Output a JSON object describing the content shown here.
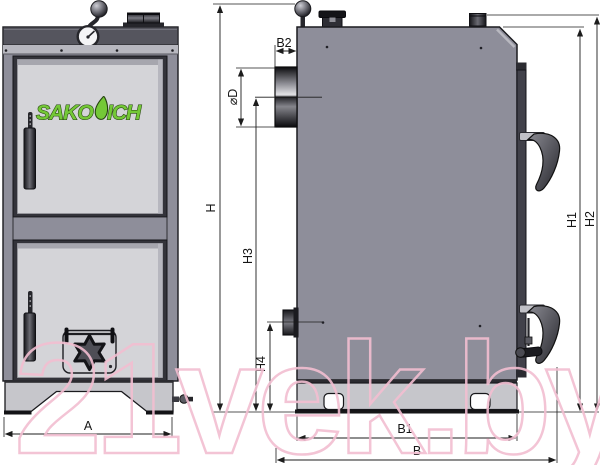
{
  "brand": {
    "name": "SAKOVICH",
    "name_left": "SAKO",
    "name_right": "ICH"
  },
  "watermark": {
    "text": "21vek.by",
    "color": "#f2bed0"
  },
  "dimension_labels": {
    "A": "A",
    "B": "B",
    "B1": "B1",
    "B2": "B2",
    "H": "H",
    "H1": "H1",
    "H2": "H2",
    "H3": "H3",
    "H4": "H4",
    "D": "⌀D"
  },
  "palette": {
    "body_gray": "#8e8e9a",
    "panel_light": "#d4d4d8",
    "band_dark": "#55555e",
    "base_gray": "#c6c6cb",
    "logo_green": "#74c837",
    "line": "#1c1c1c",
    "watermark_pink": "#f2bed0"
  }
}
